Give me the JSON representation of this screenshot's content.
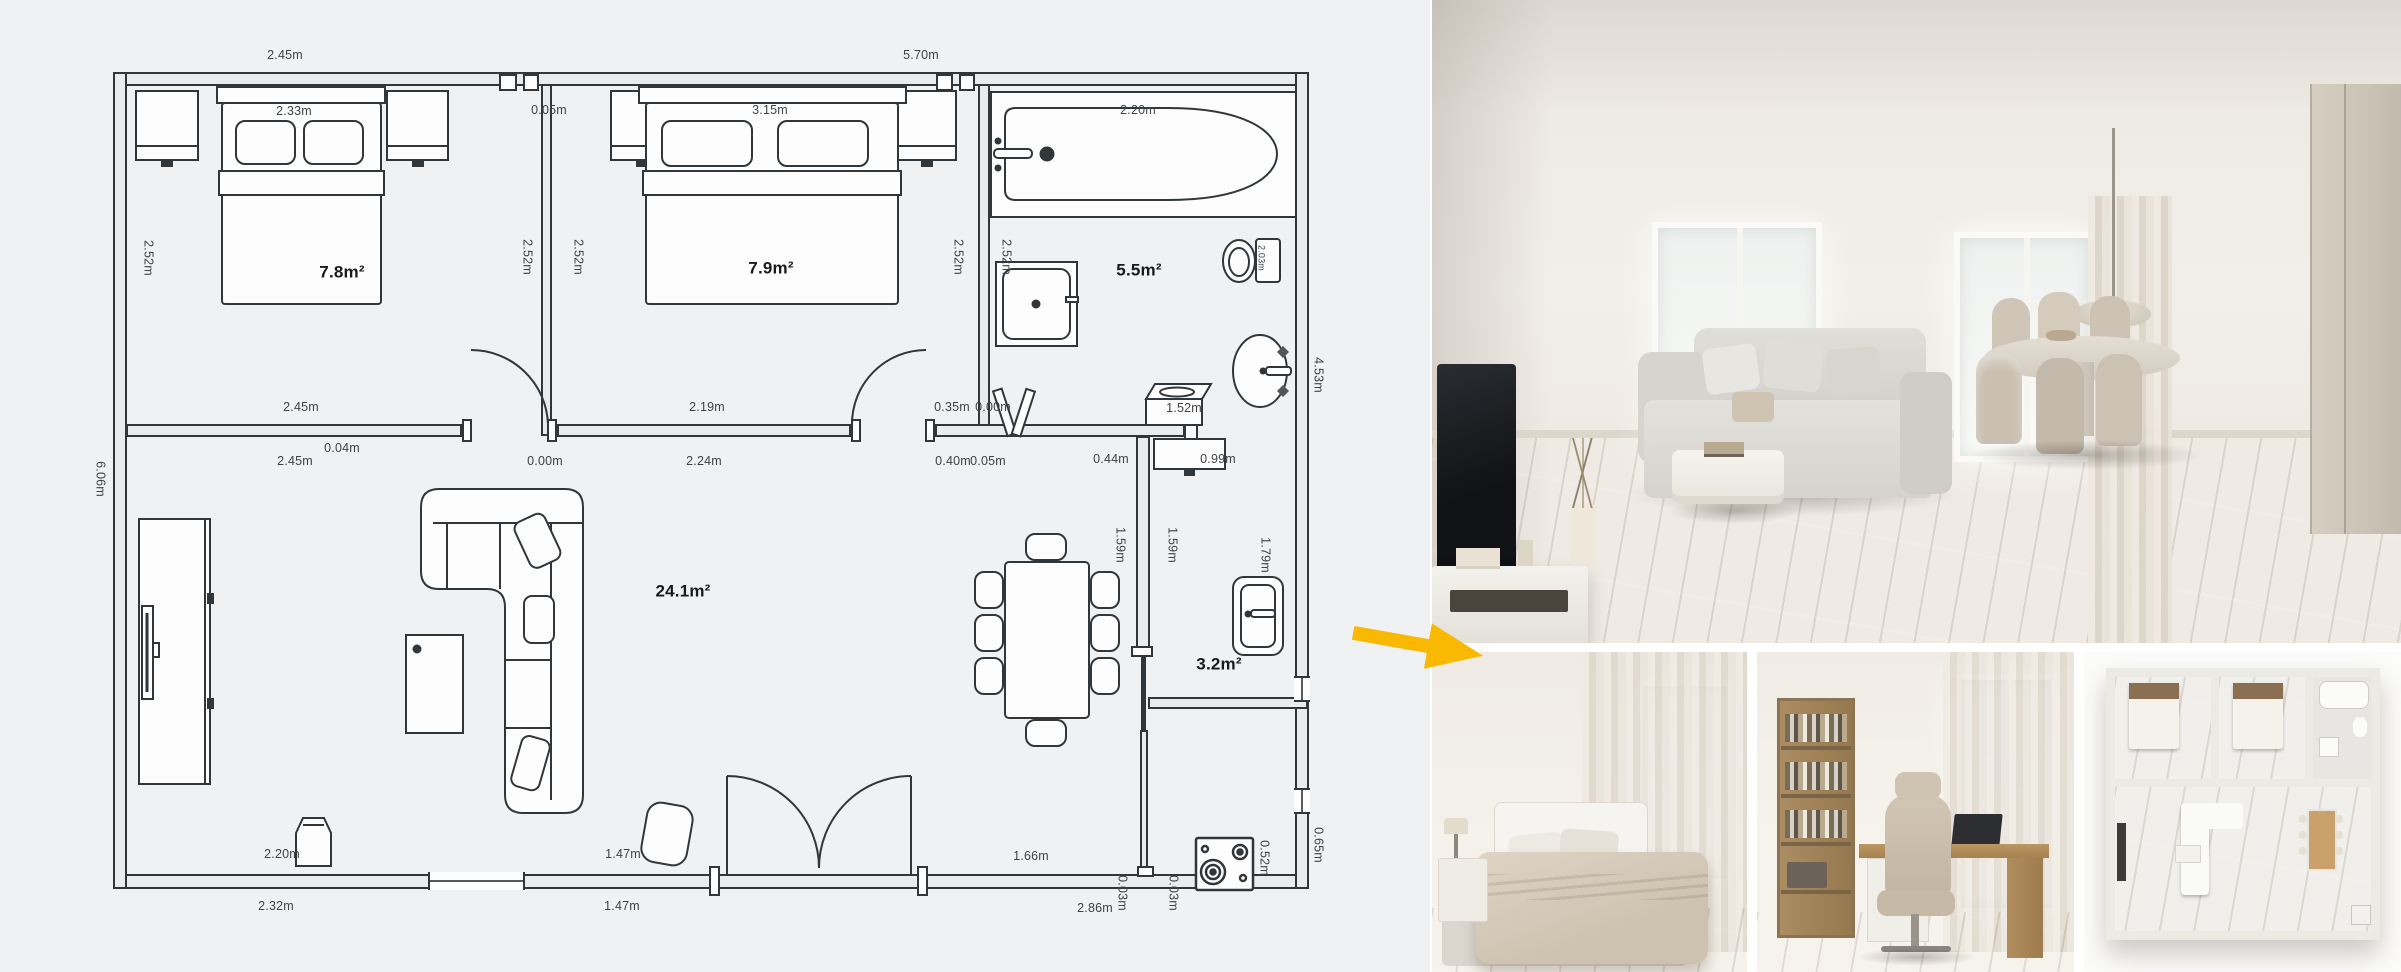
{
  "plan": {
    "bg": "#f0f1f2",
    "wall_fill": "#e9ebec",
    "line_color": "#30363a",
    "areas": {
      "bedroom1": "7.8m²",
      "bedroom2": "7.9m²",
      "bathroom": "5.5m²",
      "living": "24.1m²",
      "wc": "3.2m²"
    },
    "dims": {
      "d245": "2.45m",
      "d570": "5.70m",
      "d233": "2.33m",
      "v252": "2.52m",
      "d005": "0.05m",
      "d315": "3.15m",
      "d220": "2.20m",
      "v203": "2.03m",
      "d035": "0.35m",
      "d000": "0.00m",
      "d219": "2.19m",
      "d004": "0.04m",
      "d224": "2.24m",
      "d040": "0.40m",
      "d044": "0.44m",
      "d099": "0.99m",
      "d152": "1.52m",
      "v606": "6.06m",
      "v453": "4.53m",
      "v159": "1.59m",
      "v179": "1.79m",
      "d147": "1.47m",
      "d166": "1.66m",
      "d201": "2.01m",
      "d232": "2.32m",
      "d286": "2.86m",
      "v003": "0.03m",
      "v052": "0.52m",
      "v065": "0.65m"
    }
  },
  "arrow": {
    "color": "#F9B903"
  },
  "photos": {
    "main": "living-room-render",
    "b1": "bedroom-render",
    "b2": "home-office-render",
    "b3": "3d-floor-plan-render"
  },
  "palette": {
    "wood": "#b1874f",
    "wall": "#efece6",
    "sofa": "#d7d5d0",
    "chair": "#c9bfae"
  }
}
